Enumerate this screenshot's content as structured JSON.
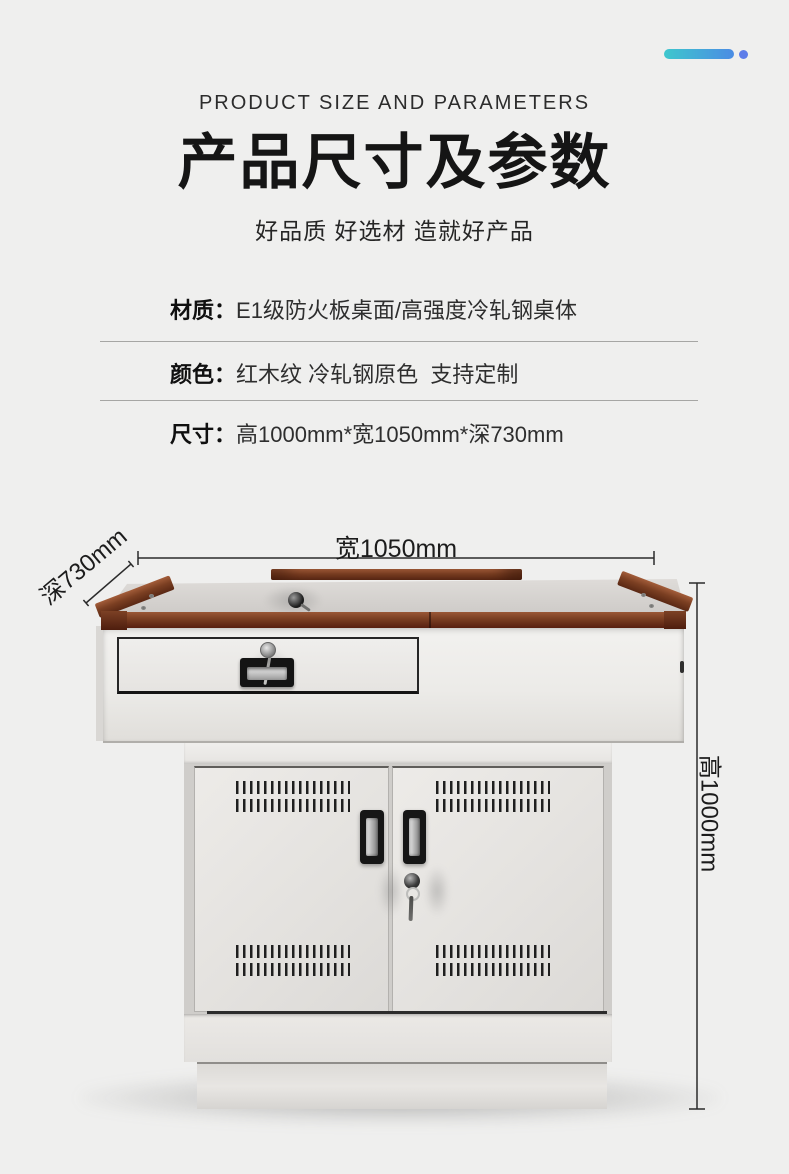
{
  "page": {
    "background_color": "#efefee"
  },
  "decor": {
    "accent_gradient_start": "#3ec7cd",
    "accent_gradient_end": "#4b8ce4",
    "accent_dot_color": "#5e7de9"
  },
  "header": {
    "eyebrow": "PRODUCT SIZE AND PARAMETERS",
    "title": "产品尺寸及参数",
    "subtitle": "好品质 好选材 造就好产品"
  },
  "specs": [
    {
      "label": "材质：",
      "value": "E1级防火板桌面/高强度冷轧钢桌体"
    },
    {
      "label": "颜色：",
      "value": "红木纹 冷轧钢原色  支持定制"
    },
    {
      "label": "尺寸：",
      "value": "高1000mm*宽1050mm*深730mm"
    }
  ],
  "dimensions": {
    "width_label": "宽1050mm",
    "depth_label": "深730mm",
    "height_label": "高1000mm"
  },
  "product_colors": {
    "wood_trim": "#7b3f22",
    "steel_body": "#e7e5e2",
    "dimension_line": "#2b2b2b"
  }
}
